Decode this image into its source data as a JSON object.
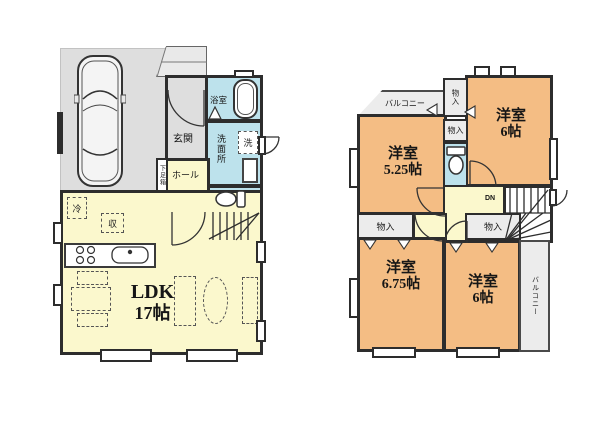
{
  "floors": {
    "f1": {
      "entrance_label": "玄関",
      "bath_label": "浴室",
      "washroom_label": "洗面所",
      "laundry_label": "洗",
      "hall_label": "ホール",
      "shoebox_label": "下足箱",
      "fridge_label": "冷",
      "storage_label": "収",
      "ldk_name": "LDK",
      "ldk_size": "17帖",
      "stairs_label": "UP"
    },
    "f2": {
      "balcony_top_label": "バルコニー",
      "balcony_right_label": "バルコニー",
      "closet_top_label": "物入",
      "closet_mid_label": "物入",
      "closet_left_label": "物入",
      "closet_right_label": "物入",
      "room525_name": "洋室",
      "room525_size": "5.25帖",
      "room6top_name": "洋室",
      "room6top_size": "6帖",
      "room675_name": "洋室",
      "room675_size": "6.75帖",
      "room6btm_name": "洋室",
      "room6btm_size": "6帖",
      "stairs_label": "DN"
    }
  },
  "colors": {
    "wall": "#2d2d2d",
    "ldk_yellow": "#fbf8cd",
    "room_orange": "#f4bd84",
    "wet_blue": "#bde2ec",
    "garage_gray": "#dedede"
  }
}
